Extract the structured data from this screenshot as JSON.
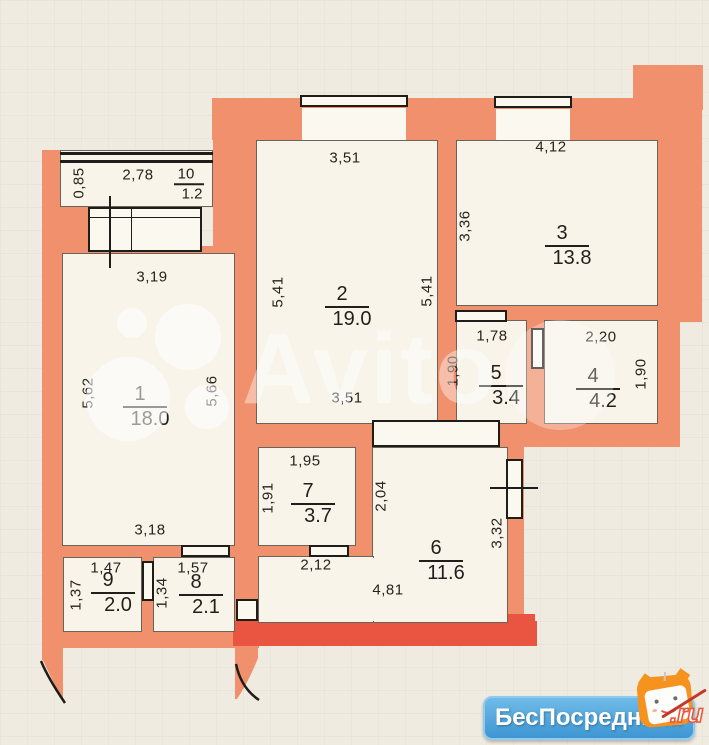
{
  "plan": {
    "rooms": [
      {
        "number": "1",
        "area": "18.0",
        "x": 145,
        "y": 407
      },
      {
        "number": "2",
        "area": "19.0",
        "x": 347,
        "y": 307
      },
      {
        "number": "3",
        "area": "13.8",
        "x": 567,
        "y": 246
      },
      {
        "number": "4",
        "area": "4.2",
        "x": 598,
        "y": 389
      },
      {
        "number": "5",
        "area": "3.4",
        "x": 501,
        "y": 386
      },
      {
        "number": "6",
        "area": "11.6",
        "x": 441,
        "y": 561
      },
      {
        "number": "7",
        "area": "3.7",
        "x": 313,
        "y": 504
      },
      {
        "number": "8",
        "area": "2.1",
        "x": 201,
        "y": 595
      },
      {
        "number": "9",
        "area": "2.0",
        "x": 113,
        "y": 593
      },
      {
        "number": "10",
        "area": "1.2",
        "x": 189,
        "y": 184,
        "small": true
      }
    ],
    "dimensions": [
      {
        "text": "0,85",
        "x": 79,
        "y": 183,
        "vertical": true
      },
      {
        "text": "2,78",
        "x": 138,
        "y": 175
      },
      {
        "text": "3,19",
        "x": 152,
        "y": 277
      },
      {
        "text": "5,62",
        "x": 88,
        "y": 393,
        "vertical": true
      },
      {
        "text": "5,66",
        "x": 212,
        "y": 391,
        "vertical": true
      },
      {
        "text": "3,51",
        "x": 345,
        "y": 158
      },
      {
        "text": "5,41",
        "x": 278,
        "y": 292,
        "vertical": true
      },
      {
        "text": "5,41",
        "x": 427,
        "y": 291,
        "vertical": true
      },
      {
        "text": "3,51",
        "x": 347,
        "y": 398
      },
      {
        "text": "4,12",
        "x": 551,
        "y": 147
      },
      {
        "text": "3,36",
        "x": 465,
        "y": 226,
        "vertical": true
      },
      {
        "text": "1,78",
        "x": 492,
        "y": 336
      },
      {
        "text": "2,20",
        "x": 601,
        "y": 337
      },
      {
        "text": "1,90",
        "x": 453,
        "y": 371,
        "vertical": true
      },
      {
        "text": "1,90",
        "x": 641,
        "y": 374,
        "vertical": true
      },
      {
        "text": "1,95",
        "x": 305,
        "y": 461
      },
      {
        "text": "1,91",
        "x": 268,
        "y": 498,
        "vertical": true
      },
      {
        "text": "2,04",
        "x": 381,
        "y": 496,
        "vertical": true
      },
      {
        "text": "3,18",
        "x": 150,
        "y": 530
      },
      {
        "text": "2,12",
        "x": 316,
        "y": 565
      },
      {
        "text": "4,81",
        "x": 388,
        "y": 590
      },
      {
        "text": "3,32",
        "x": 497,
        "y": 533,
        "vertical": true
      },
      {
        "text": "1,47",
        "x": 106,
        "y": 568
      },
      {
        "text": "1,37",
        "x": 76,
        "y": 595,
        "vertical": true
      },
      {
        "text": "1,57",
        "x": 193,
        "y": 568
      },
      {
        "text": "1,34",
        "x": 162,
        "y": 593,
        "vertical": true
      }
    ]
  },
  "watermark": {
    "text": "Avito"
  },
  "logo": {
    "text": "БесПосредника",
    "suffix": ".ru"
  },
  "colors": {
    "bg": "#f0ebe1",
    "wall": "#f0906c",
    "wall_bright": "#e95540",
    "room": "#f8f4ea",
    "logo_blue": "#4aa3dc",
    "logo_orange": "#f6921e",
    "logo_red": "#e8563c"
  }
}
